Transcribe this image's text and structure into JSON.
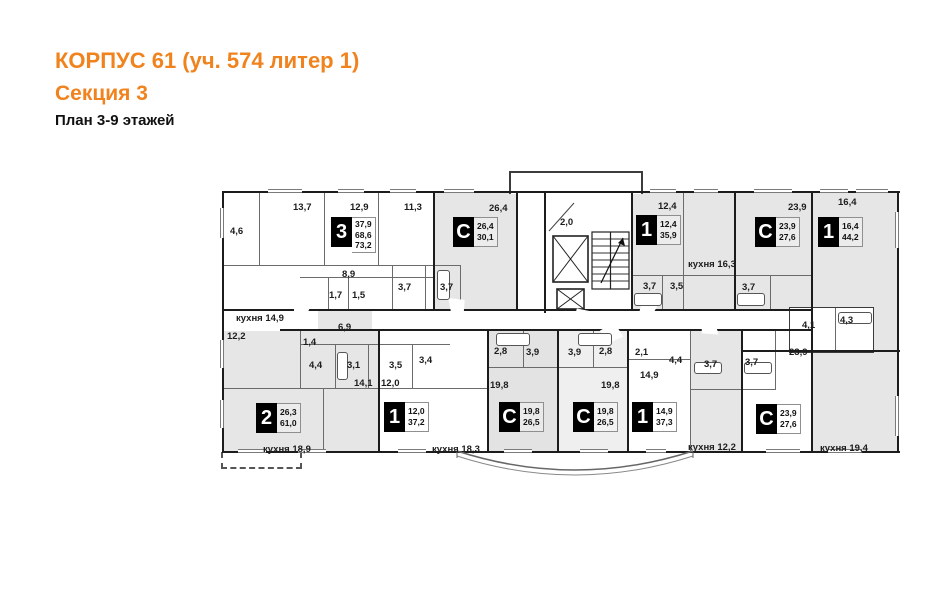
{
  "header": {
    "title": "КОРПУС 61 (уч. 574 литер 1)",
    "subtitle": "Секция 3",
    "plan_label": "План 3-9 этажей"
  },
  "colors": {
    "accent_orange": "#F0831D",
    "wall_black": "#1c1c1c",
    "apartment_gray": "#e6e6e6"
  },
  "apartments": [
    {
      "id": "apt-3room-top-left",
      "type": "3",
      "areas": [
        "37,9",
        "68,6",
        "73,2"
      ]
    },
    {
      "id": "studio-top-center",
      "type": "С",
      "areas": [
        "26,4",
        "30,1"
      ]
    },
    {
      "id": "apt-1room-top",
      "type": "1",
      "areas": [
        "12,4",
        "35,9"
      ]
    },
    {
      "id": "studio-top-right",
      "type": "С",
      "areas": [
        "23,9",
        "27,6"
      ]
    },
    {
      "id": "apt-1room-right",
      "type": "1",
      "areas": [
        "16,4",
        "44,2"
      ]
    },
    {
      "id": "apt-2room-bottom-left",
      "type": "2",
      "areas": [
        "26,3",
        "61,0"
      ]
    },
    {
      "id": "apt-1room-bottom-left",
      "type": "1",
      "areas": [
        "12,0",
        "37,2"
      ]
    },
    {
      "id": "studio-bottom-left",
      "type": "С",
      "areas": [
        "19,8",
        "26,5"
      ]
    },
    {
      "id": "studio-bottom-center",
      "type": "С",
      "areas": [
        "19,8",
        "26,5"
      ]
    },
    {
      "id": "apt-1room-bottom-right",
      "type": "1",
      "areas": [
        "14,9",
        "37,3"
      ]
    },
    {
      "id": "studio-bottom-right",
      "type": "С",
      "areas": [
        "23,9",
        "27,6"
      ]
    }
  ],
  "rooms": [
    "4,6",
    "13,7",
    "12,9",
    "11,3",
    "26,4",
    "2,0",
    "12,4",
    "кухня 16,3",
    "23,9",
    "16,4",
    "8,9",
    "1,7",
    "1,5",
    "3,7",
    "3,7",
    "кухня 14,9",
    "12,2",
    "6,9",
    "1,4",
    "4,4",
    "3,1",
    "3,5",
    "3,4",
    "14,1",
    "12,0",
    "3,7",
    "3,5",
    "3,7",
    "4,1",
    "4,3",
    "23,9",
    "2,8",
    "3,9",
    "19,8",
    "3,9",
    "2,8",
    "19,8",
    "2,1",
    "14,9",
    "4,4",
    "3,7",
    "3,7",
    "кухня 12,2",
    "кухня 18,9",
    "кухня 18,3",
    "кухня 19,4"
  ]
}
